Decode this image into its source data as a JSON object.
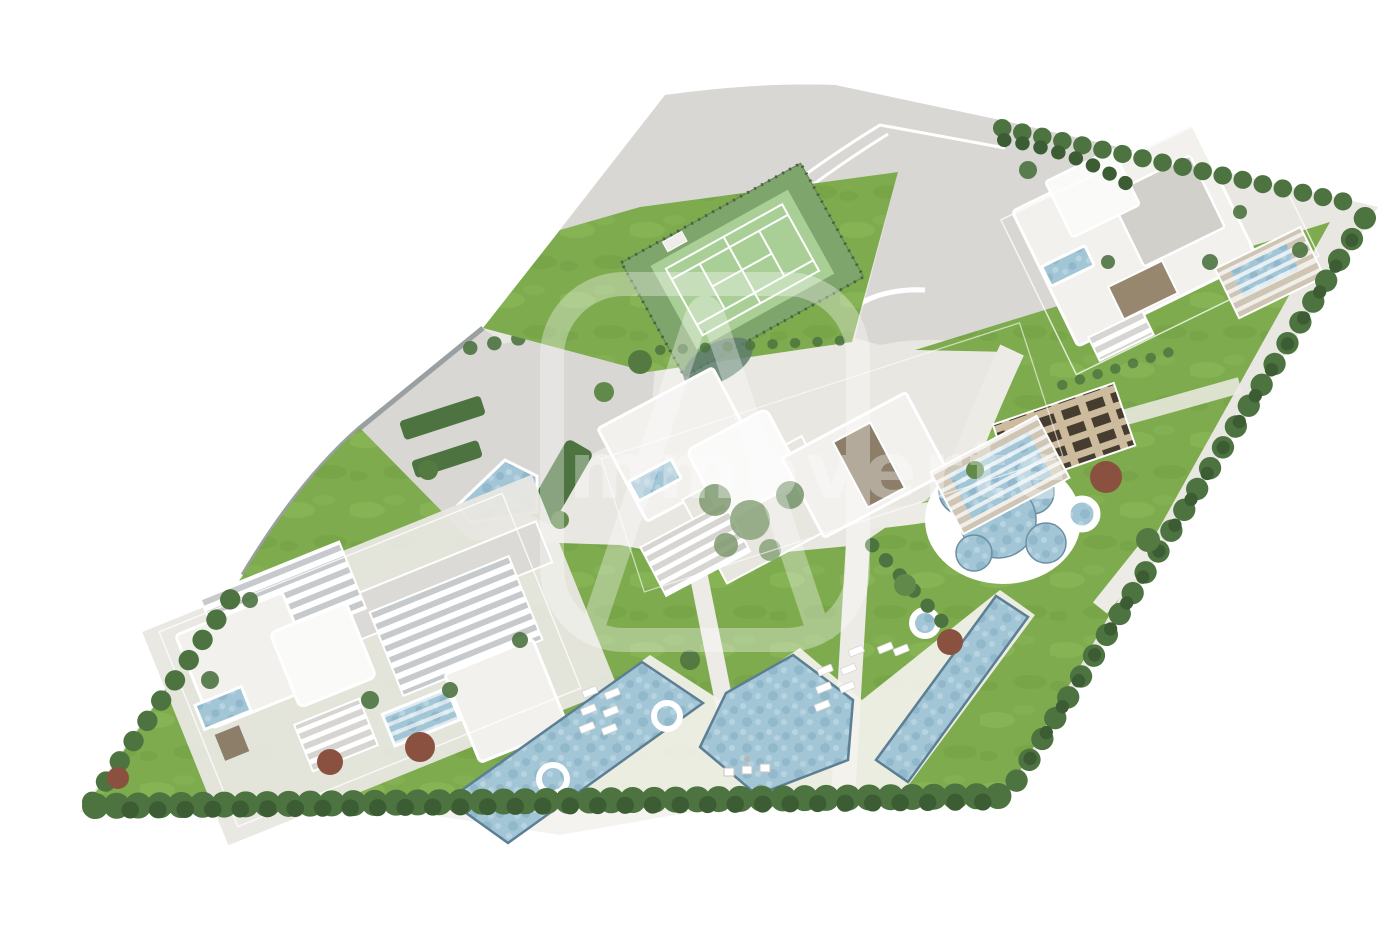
{
  "scene": {
    "description": "Aerial top-down 3D architectural render of a residential resort site plan on a skewed parallelogram plot with white modern buildings, rooftop pools, lawns, a tennis court, freeform swimming pools and perimeter hedges",
    "background_color": "#ffffff"
  },
  "watermark": {
    "text": "immoverte",
    "logo": "rounded-square-A-monogram",
    "color": "#ffffff",
    "opacity": "0.34"
  },
  "palette": {
    "white": "#ffffff",
    "pavement": "#e9e7e2",
    "road": "#d8d7d4",
    "curb": "#9aa0a2",
    "path": "#edebe5",
    "lawn": "#7dab4d",
    "lawnLight": "#90bf60",
    "lawnDark": "#6d9a42",
    "hedge": "#4c7340",
    "hedgeDark": "#3c5c33",
    "treeRed": "#8a5140",
    "building": "#f2f1ed",
    "roofBright": "#fafaf9",
    "roofGray": "#d2d0cb",
    "deckBrown": "#97876f",
    "pergolaBrown": "#8d7e69",
    "pool": "#a3c6d7",
    "poolDeep": "#7fa8bd",
    "poolLight": "#c6dde8",
    "poolEdge": "#5c7f94",
    "court": "#a9cf97",
    "courtBand": "#7ea56b",
    "courtFence": "#4a5f41",
    "tealPond": "#5e7c6d",
    "plotSoil": "#cdbb9d",
    "plotDark": "#473c30"
  },
  "features": {
    "site": "parallelogram plot",
    "tennis_court": "tennis court",
    "north_road": "access road with lane markings",
    "west_parking": "parking area with hedges",
    "northeast_buildings": "villa cluster with rooftop pools",
    "center_buildings": "central building cluster with pergola pool and stairs",
    "southwest_buildings": "large residence with slatted pergola roofs",
    "garden_plots": "community garden plots",
    "bubble_pool": "freeform circular family pool",
    "south_pools": "zig-zag lap pools with sun loungers",
    "perimeter": "hedge and tree border"
  }
}
